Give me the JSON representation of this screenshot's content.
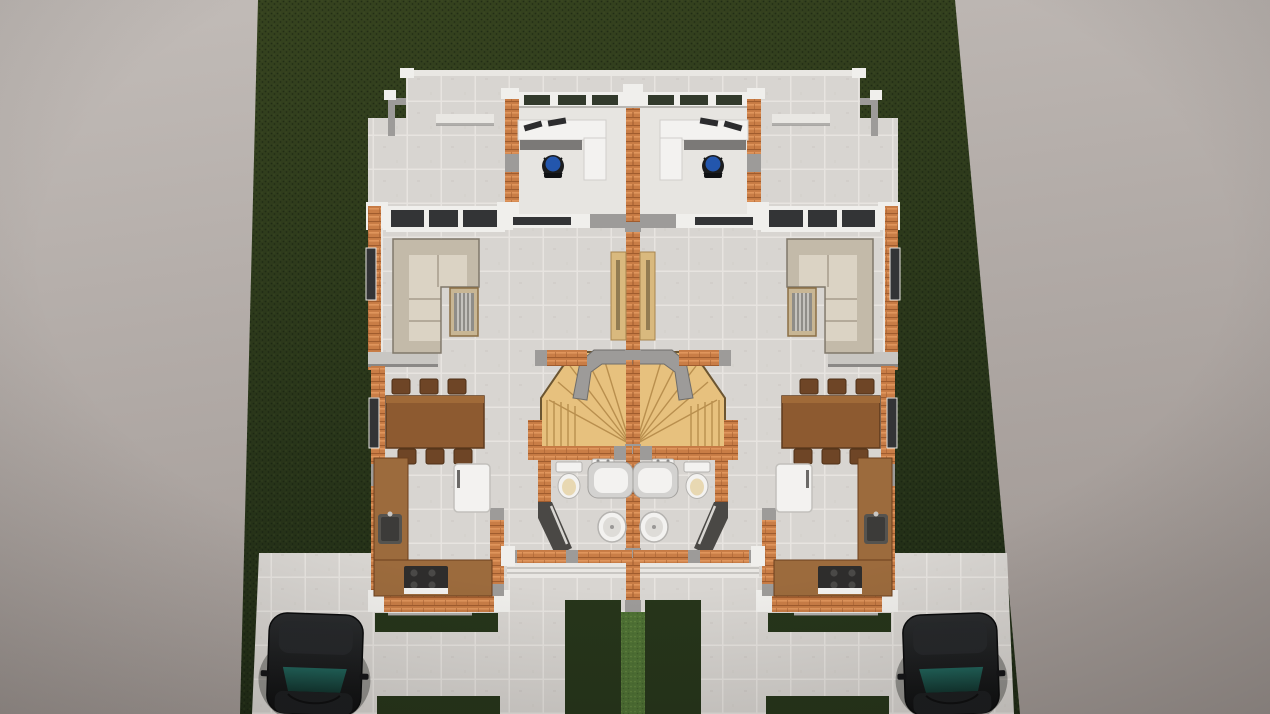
{
  "scene": {
    "type": "architectural-3d-render",
    "view": "top-down aerial perspective",
    "subject": "Symmetrical duplex house shown as a furnished open-roof floor plan on a dark green lawn plot, with front walkways, entry steps, driveways and two parked cars, over a plain gray backdrop"
  },
  "units": {
    "count": 2,
    "arrangement": "mirrored about central party wall",
    "rooms": [
      "home office",
      "hallway",
      "living room",
      "dining area",
      "staircase",
      "bathroom",
      "kitchen",
      "front porch"
    ],
    "furniture": [
      "l-shaped sectional sofa",
      "slatted side table",
      "entry console",
      "dining table with six chairs",
      "l-shaped kitchen counter",
      "gas stove",
      "kitchen sink",
      "refrigerator",
      "corner office desk",
      "desk monitors",
      "blue office chair",
      "toilet",
      "wall sink",
      "vanity basin",
      "oval bathtub"
    ]
  },
  "exterior": {
    "features": [
      "lawn plot",
      "central grass strip",
      "grass patches",
      "tiled walkways",
      "entry steps",
      "side steps",
      "top patio with parapet",
      "driveways"
    ],
    "vehicle_count": 2,
    "vehicles": [
      "dark sedan left driveway",
      "dark sedan right driveway"
    ]
  },
  "palette": {
    "backdrop_light": "#c2bcb8",
    "backdrop_dark": "#a29a96",
    "lawn_light": "#36431f",
    "lawn_dark": "#202c16",
    "lawn_patch": "#26351a",
    "lawn_strip": "#4e7134",
    "lawn_strip_speck": "#6f9048",
    "tile": "#d8d5d1",
    "tile_line": "#e7e4e0",
    "office_floor": "#e7e5e1",
    "brick": "#c97d46",
    "brick_light": "#e0955c",
    "brick_dark": "#a05c2e",
    "wall_white": "#f0efec",
    "wall_gray": "#9d9b99",
    "wall_charcoal": "#4a4845",
    "glass_dark": "#333436",
    "glass_green": "#323a2c",
    "sofa": "#dbd3c4",
    "sofa_dark": "#c3baa9",
    "wood": "#8d5a30",
    "wood_top": "#a06a38",
    "wood_dark": "#6e4526",
    "counter": "#9c6b3d",
    "stairs": "#e7c17e",
    "stairs_edge": "#b98f4e",
    "fixture": "#f3f2f0",
    "fixture_gray": "#d3d2d0",
    "seat_beige": "#e8d8b2",
    "chair_blue": "#2356ad",
    "appliance": "#2e2d2c",
    "steps": "#e9e7e3",
    "console_tan": "#d9b97e",
    "car_top": "#2a2c2e",
    "car_bottom": "#0c0d0e",
    "car_glass_top": "#20635a",
    "car_glass_bottom": "#11352f"
  }
}
